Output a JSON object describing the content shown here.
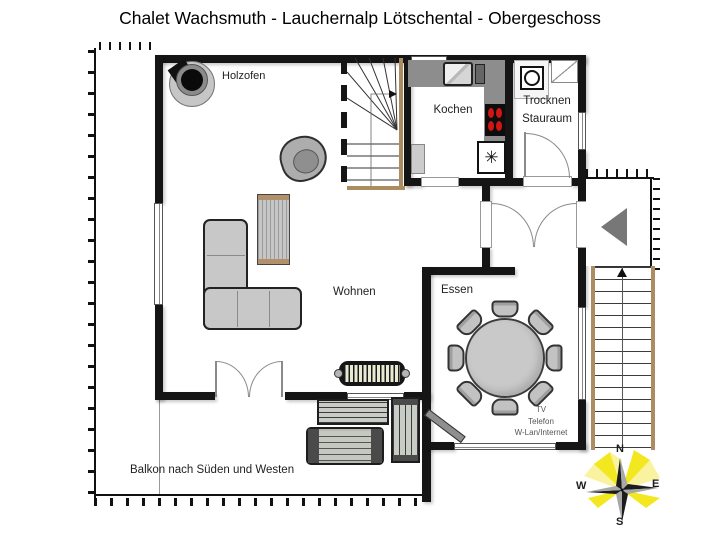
{
  "title": "Chalet Wachsmuth - Lauchernalp Lötschental - Obergeschoss",
  "labels": {
    "holzofen": "Holzofen",
    "kochen": "Kochen",
    "trocknen": "Trocknen",
    "stauraum": "Stauraum",
    "wohnen": "Wohnen",
    "essen": "Essen",
    "balkon": "Balkon nach Süden und Westen"
  },
  "amenities": [
    "TV",
    "Telefon",
    "W-Lan/Internet"
  ],
  "compass": {
    "n": "N",
    "e": "E",
    "s": "S",
    "w": "W"
  },
  "symbols": {
    "freezer": "✳"
  },
  "colors": {
    "wall": "#151515",
    "kitchen_counter": "#8d8d8d",
    "stair_rail": "#ab8c63",
    "stove_burner": "#d31515",
    "compass_ray_yellow": "#f3e81f",
    "furniture_gray": "#c8c8c8"
  }
}
